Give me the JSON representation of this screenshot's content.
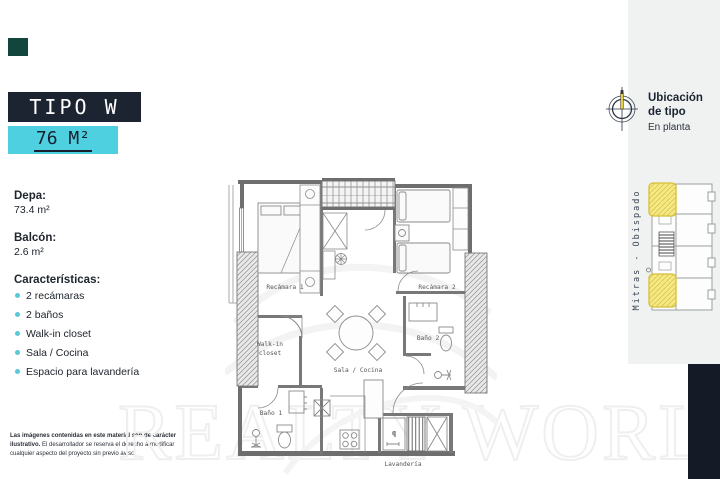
{
  "badges": {
    "tipo": "TIPO W",
    "area": "76 M²"
  },
  "info": {
    "depa_label": "Depa:",
    "depa_value": "73.4 m²",
    "balcon_label": "Balcón:",
    "balcon_value": "2.6 m²",
    "caracteristicas_label": "Características:",
    "features": [
      "2 recámaras",
      "2 baños",
      "Walk-in closet",
      "Sala / Cocina",
      "Espacio para lavandería"
    ]
  },
  "disclaimer": {
    "bold": "Las imágenes contenidas en este material son de carácter ilustrativo.",
    "regular": " El desarrollador se reserva el derecho a modificar cualquier aspecto del proyecto sin previo aviso."
  },
  "plan": {
    "rooms": {
      "recamara1": "Recámara 1",
      "recamara2": "Recámara 2",
      "walkin1": "Walk-in",
      "walkin2": "closet",
      "sala": "Sala / Cocina",
      "bano1": "Baño 1",
      "bano2": "Baño 2",
      "lavanderia": "Lavandería"
    }
  },
  "location": {
    "title1": "Ubicación",
    "title2": "de tipo",
    "subtitle": "En planta",
    "zone": "Mitras - Obispado"
  },
  "watermark": "REALTY WORLD",
  "colors": {
    "accent_cyan": "#4fd0e0",
    "dark_navy": "#1c2431",
    "panel_gray": "#f0f2f2",
    "highlight_yellow": "#f2e27d",
    "green_mark": "#12463c"
  }
}
